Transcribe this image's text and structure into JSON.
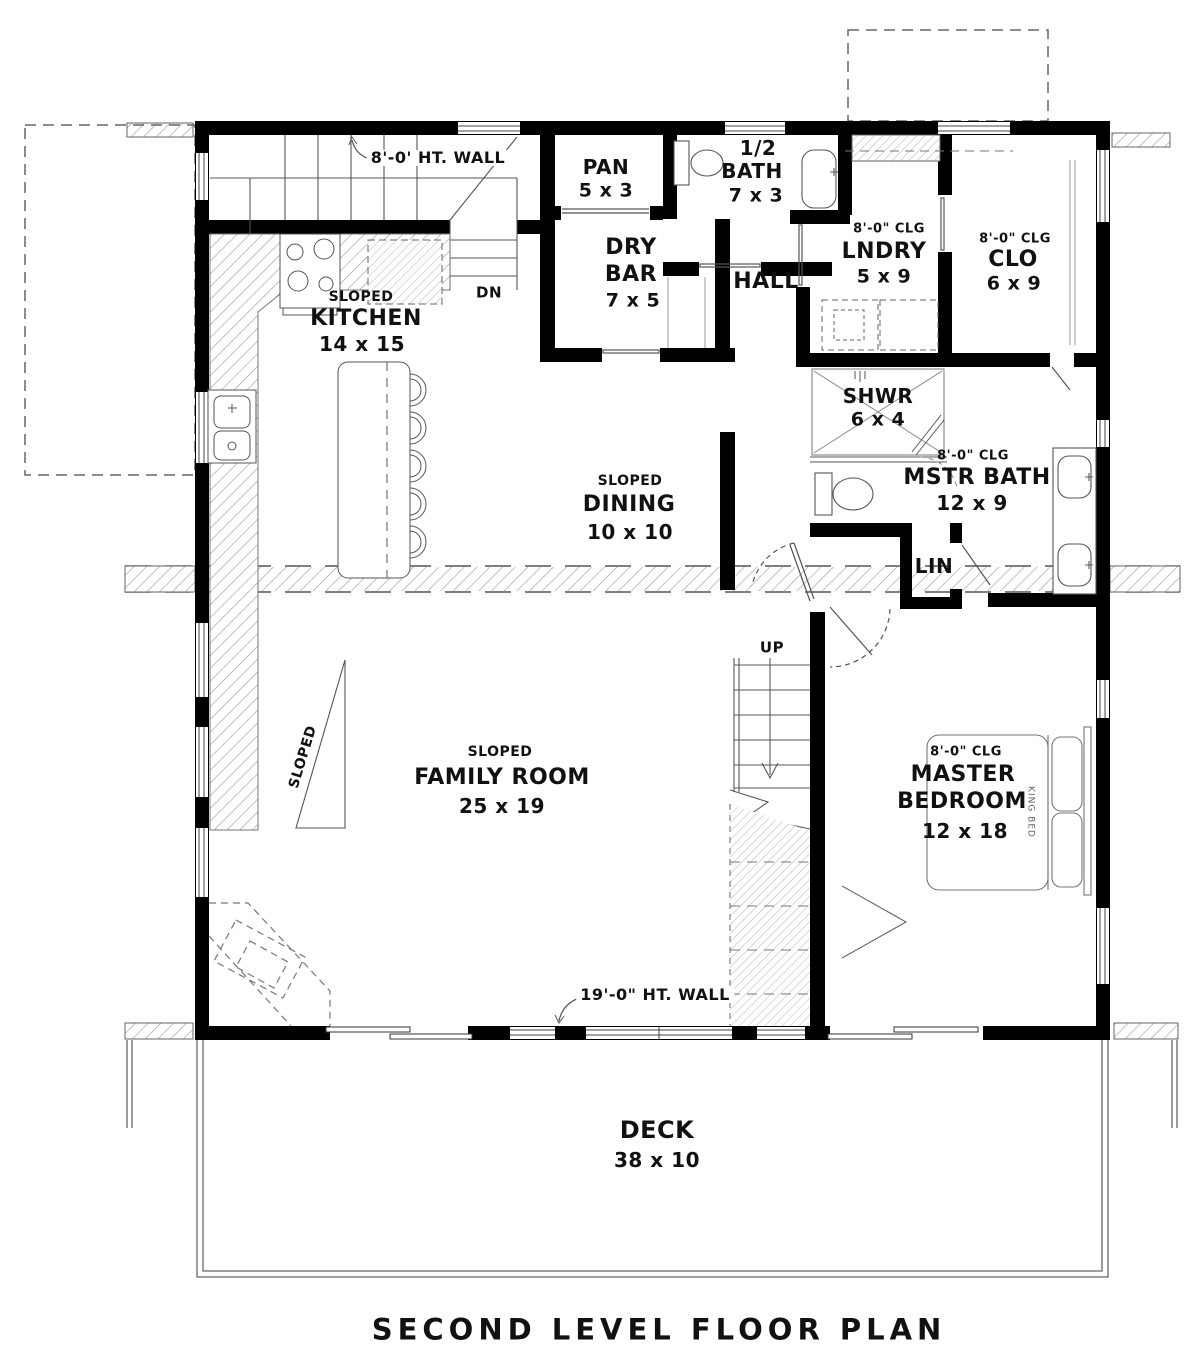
{
  "title": "SECOND LEVEL FLOOR PLAN",
  "notes": {
    "top_wall": "8'-0' HT. WALL",
    "bottom_wall": "19'-0\" HT. WALL",
    "down": "DN",
    "up": "UP",
    "sloped": "SLOPED"
  },
  "rooms": {
    "kitchen": {
      "sloped": "SLOPED",
      "name": "KITCHEN",
      "dims": "14 x 15"
    },
    "pan": {
      "name": "PAN",
      "dims": "5 x 3"
    },
    "half_bath": {
      "line1": "1/2",
      "line2": "BATH",
      "dims": "7 x 3"
    },
    "dry_bar": {
      "line1": "DRY",
      "line2": "BAR",
      "dims": "7 x 5"
    },
    "hall": {
      "name": "HALL"
    },
    "laundry": {
      "ceiling": "8'-0\" CLG",
      "name": "LNDRY",
      "dims": "5 x 9"
    },
    "closet": {
      "ceiling": "8'-0\" CLG",
      "name": "CLO",
      "dims": "6 x 9"
    },
    "shower": {
      "name": "SHWR",
      "dims": "6 x 4"
    },
    "master_bath": {
      "ceiling": "8'-0\" CLG",
      "name": "MSTR BATH",
      "dims": "12 x 9"
    },
    "linen": {
      "name": "LIN"
    },
    "dining": {
      "sloped": "SLOPED",
      "name": "DINING",
      "dims": "10 x 10"
    },
    "family_room": {
      "sloped": "SLOPED",
      "name": "FAMILY ROOM",
      "dims": "25 x 19"
    },
    "master_bedroom": {
      "ceiling": "8'-0\" CLG",
      "line1": "MASTER",
      "line2": "BEDROOM",
      "dims": "12 x 18"
    },
    "deck": {
      "name": "DECK",
      "dims": "38 x 10"
    }
  },
  "furniture": {
    "bed": "KING BED"
  },
  "colors": {
    "wall": "#000000",
    "line": "#555555",
    "hatch": "#999999"
  }
}
